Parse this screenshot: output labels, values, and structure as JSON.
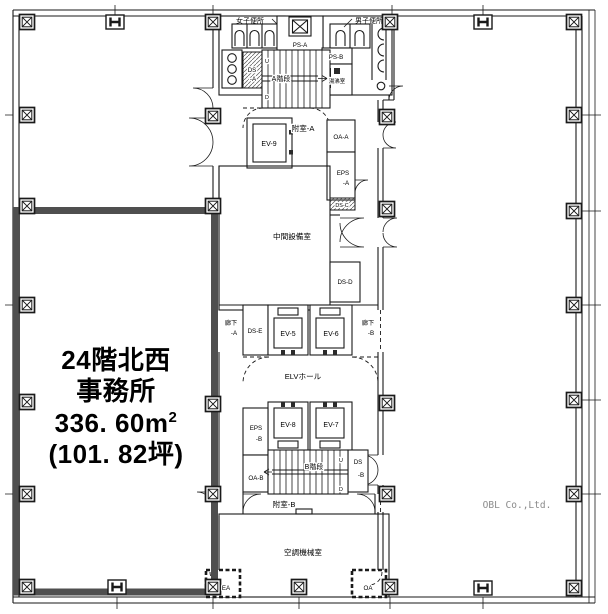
{
  "colors": {
    "wall_line": "#1a1a1a",
    "office_highlight": "#4f4f4f",
    "watermark_gray": "#8a8a8a",
    "background": "#ffffff"
  },
  "office": {
    "line1": "24階北西",
    "line2": "事務所",
    "line3a": "336. 60m",
    "line3b": "2",
    "line4": "(101. 82坪)"
  },
  "watermark": "OBL Co.,Ltd.",
  "rooms": {
    "women_toilet": "女子便所",
    "men_toilet": "男子便所",
    "ps_a": "PS-A",
    "ps_b": "PS-B",
    "yuwakashi": "湯沸室",
    "ds_a": [
      "DS",
      "-A"
    ],
    "stair_a": "A階段",
    "stair_b": "B階段",
    "fushitsu_a": "附室-A",
    "fushitsu_b": "附室-B",
    "ev9": "EV-9",
    "ev5": "EV-5",
    "ev6": "EV-6",
    "ev7": "EV-7",
    "ev8": "EV-8",
    "oa_a": "OA-A",
    "oa_b": "OA-B",
    "eps_a": [
      "EPS",
      "-A"
    ],
    "eps_b": [
      "EPS",
      "-B"
    ],
    "ds_b": [
      "DS",
      "-B"
    ],
    "ds_c": "DS-C",
    "ds_d": "DS-D",
    "ds_e": "DS-E",
    "rouka_a": [
      "廊下",
      "-A"
    ],
    "rouka_b": [
      "廊下",
      "-B"
    ],
    "elv_hall": "ELVホール",
    "chukan": "中間設備室",
    "kucho": "空調機械室",
    "ea": "EA",
    "oa": "OA",
    "up": "U",
    "down": "D"
  }
}
